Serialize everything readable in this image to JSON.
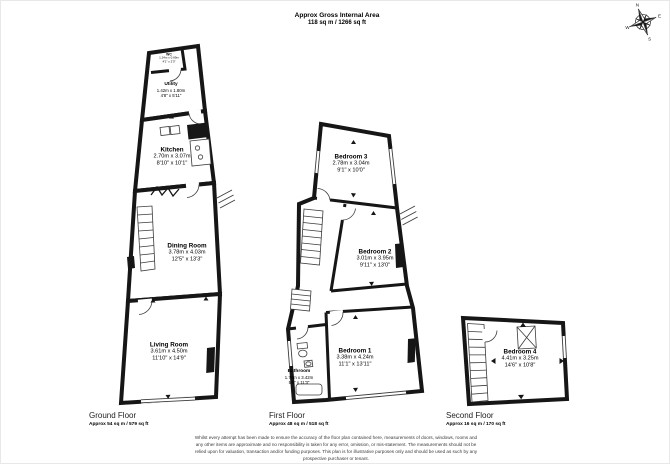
{
  "header": {
    "title": "Approx Gross Internal Area",
    "subtitle": "118 sq m / 1266 sq ft"
  },
  "compass": {
    "n": "N",
    "e": "E",
    "s": "S",
    "w": "W"
  },
  "floors": [
    {
      "name": "Ground Floor",
      "area": "Approx 54 sq m / 579 sq ft"
    },
    {
      "name": "First Floor",
      "area": "Approx 48 sq m / 518 sq ft"
    },
    {
      "name": "Second Floor",
      "area": "Approx 16 sq m / 170 sq ft"
    }
  ],
  "rooms": {
    "wc": {
      "name": "WC",
      "metric": "1.24m x 0.69m",
      "imperial": "4'1\" x 2'3\""
    },
    "utility": {
      "name": "Utility",
      "metric": "1.42m x 1.80m",
      "imperial": "4'8\" x 5'11\""
    },
    "kitchen": {
      "name": "Kitchen",
      "metric": "2.70m x 3.07m",
      "imperial": "8'10\" x 10'1\""
    },
    "dining_room": {
      "name": "Dining Room",
      "metric": "3.78m x 4.03m",
      "imperial": "12'5\" x 13'3\""
    },
    "living_room": {
      "name": "Living Room",
      "metric": "3.61m x 4.50m",
      "imperial": "11'10\" x 14'9\""
    },
    "bedroom_3": {
      "name": "Bedroom 3",
      "metric": "2.78m x 3.04m",
      "imperial": "9'1\" x 10'0\""
    },
    "bedroom_2": {
      "name": "Bedroom 2",
      "metric": "3.01m x 3.95m",
      "imperial": "9'11\" x 13'0\""
    },
    "bedroom_1": {
      "name": "Bedroom 1",
      "metric": "3.38m x 4.24m",
      "imperial": "11'1\" x 13'11\""
    },
    "bathroom": {
      "name": "Bathroom",
      "metric": "1.74m x 3.42m",
      "imperial": "5'9\" x 11'3\""
    },
    "bedroom_4": {
      "name": "Bedroom 4",
      "metric": "4.41m x 3.25m",
      "imperial": "14'6\" x 10'8\""
    }
  },
  "disclaimer": {
    "lines": [
      "Whilst every attempt has been made to ensure the accuracy of the floor plan contained here, measurements of doors, windows, rooms and",
      "any other items are approximate and no responsibility is taken for any error, omission, or mis-statement. The measurements should not be",
      "relied upon for valuation, transaction and/or funding purposes. This plan is for illustrative purposes only and should be used as such by any",
      "prospective purchaser or tenant."
    ]
  },
  "colors": {
    "walls": "#161616",
    "text": "#000000",
    "disclaimer_text": "#3a3a3a"
  }
}
